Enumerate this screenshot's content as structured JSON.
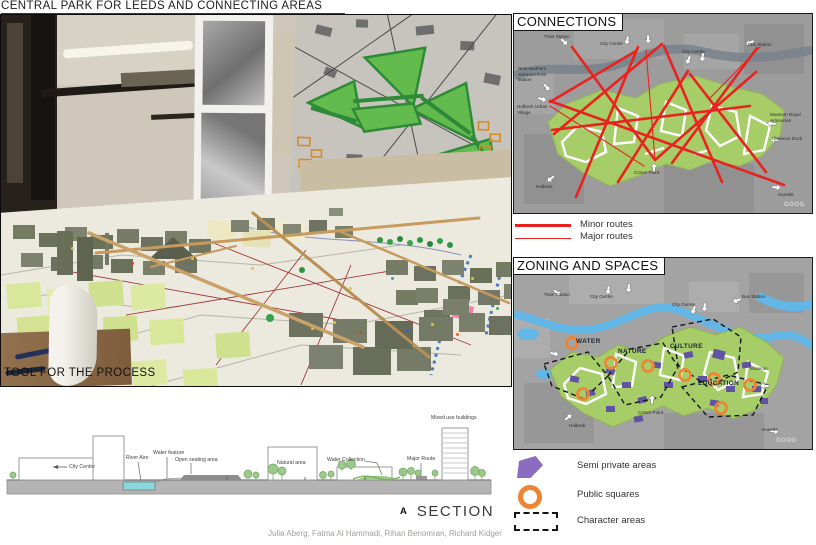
{
  "page": {
    "title": "CENTRAL PARK FOR LEEDS AND CONNECTING AREAS",
    "credits": "Julia Aberg, Fatma Al Hammadi, Rihan Benomran, Richard Kidger"
  },
  "photo": {
    "caption": "TOOL FOR THE PROCESS"
  },
  "connections": {
    "title": "CONNECTIONS",
    "watermark": "GOOG",
    "route_color": "#e8231f",
    "labels": [
      "Train Station",
      "City Centre",
      "City Centre",
      "Bus Station",
      "New southern entrance from station",
      "Holbeck Urban Village",
      "Museum Royal Armouries",
      "Clarence Dock",
      "Crown Point",
      "Holbeck",
      "Hunslet"
    ],
    "legend": [
      {
        "label": "Minor routes",
        "style": "thick"
      },
      {
        "label": "Major routes",
        "style": "thin"
      }
    ]
  },
  "zoning": {
    "title": "ZONING AND SPACES",
    "watermark": "GOOG",
    "labels": [
      "Train Station",
      "City Centre",
      "City Centre",
      "Bus Station",
      "Museum",
      "Crown Point",
      "Holbeck",
      "Hunslet"
    ],
    "zones": [
      "WATER",
      "NATURE",
      "CULTURE",
      "EDUCATION"
    ],
    "colors": {
      "park": "#a6cd67",
      "river": "#62b7e6",
      "semi_private": "#6053a2",
      "public_square": "#ef8434"
    }
  },
  "legend": {
    "items": [
      {
        "label": "Semi private areas",
        "swatch": "purple-polygon"
      },
      {
        "label": "Public squares",
        "swatch": "orange-ring"
      },
      {
        "label": "Character areas",
        "swatch": "dashed-box"
      }
    ]
  },
  "section": {
    "marker": "A",
    "title": "SECTION",
    "labels": [
      "City Centre",
      "River Aire",
      "Water feature",
      "Open seating area",
      "Natural area",
      "Water Collection",
      "Major Route",
      "Mixed use buildings"
    ]
  }
}
